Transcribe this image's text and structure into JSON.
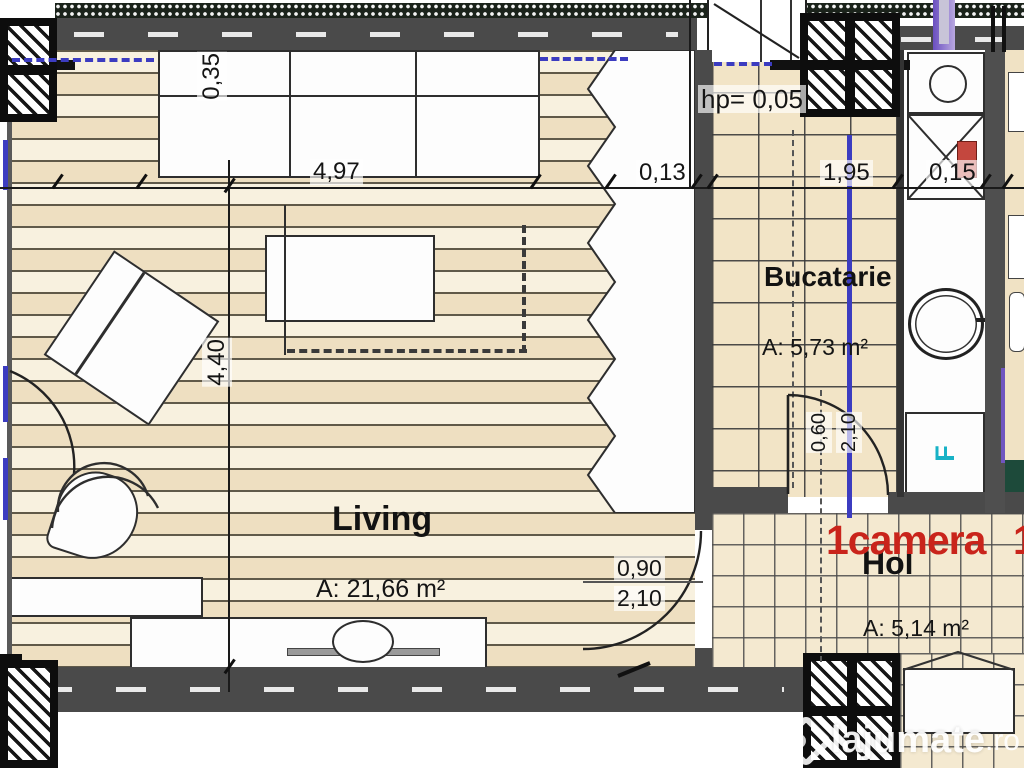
{
  "plan": {
    "badge": {
      "text": "1camera",
      "partial": "1"
    },
    "rooms": {
      "living": {
        "name": "Living",
        "area": "A: 21,66 m²"
      },
      "kitchen": {
        "name": "Bucatarie",
        "area": "A: 5,73 m²"
      },
      "hall": {
        "name": "Hol",
        "area": "A: 5,14 m²"
      }
    },
    "dims": {
      "closet_depth": "0,35",
      "living_width": "4,97",
      "wall_a": "0,13",
      "parapet": "hp= 0,05",
      "kitchen_width": "1,95",
      "wall_b": "0,15",
      "living_height": "4,40",
      "door_w": "0,90",
      "door_h": "2,10",
      "kdoor_w": "0,60",
      "kdoor_h": "2,10"
    },
    "appliances": {
      "fridge": "F"
    }
  },
  "watermark": {
    "brand": "lajumate",
    "tld": ".ro"
  },
  "colors": {
    "accent_red": "#c9241b",
    "pipe_blue": "#3c3cc0",
    "pipe_purple": "#7055c0",
    "fridge_teal": "#18b2c6",
    "wall_gray": "#4a4a4a",
    "floor_beige": "#f2e4c6"
  }
}
